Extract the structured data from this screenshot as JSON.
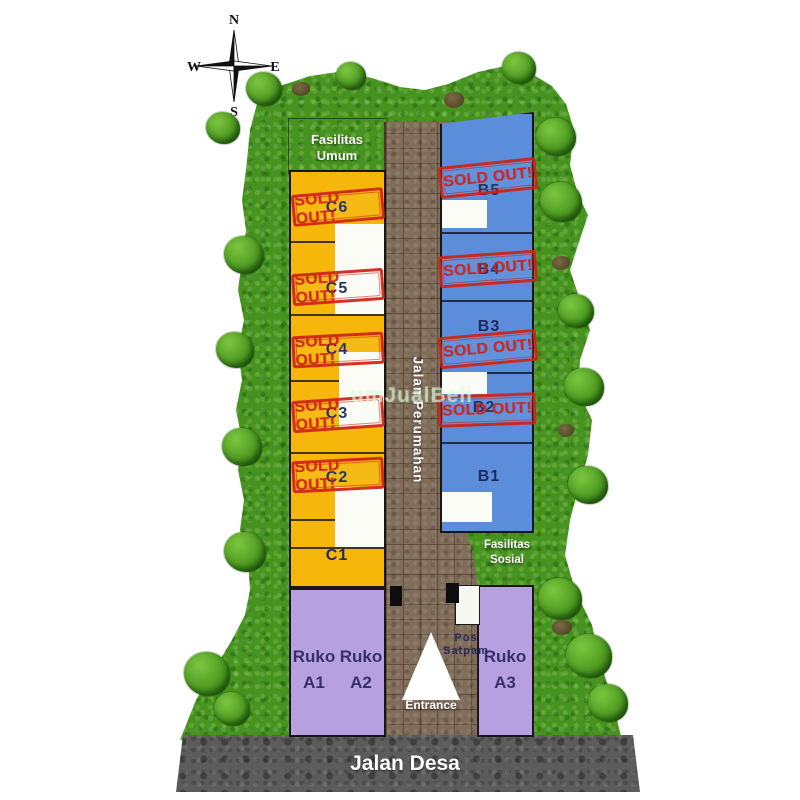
{
  "compass": {
    "north": "N",
    "east": "E",
    "south": "S",
    "west": "W"
  },
  "labels": {
    "fasilitas_umum_line1": "Fasilitas",
    "fasilitas_umum_line2": "Umum",
    "fasilitas_sosial_line1": "Fasilitas",
    "fasilitas_sosial_line2": "Sosial",
    "pos_satpam_line1": "Pos",
    "pos_satpam_line2": "Satpam",
    "entrance": "Entrance",
    "jalan_perumahan": "Jalan Perumahan",
    "jalan_desa": "Jalan Desa"
  },
  "stamp": {
    "text": "SOLD OUT!",
    "color": "#cf2318"
  },
  "blocks": {
    "c_column": {
      "color": "#f6b70a",
      "units": [
        {
          "label": "C6",
          "sold_out": true
        },
        {
          "label": "C5",
          "sold_out": true
        },
        {
          "label": "C4",
          "sold_out": true
        },
        {
          "label": "C3",
          "sold_out": true
        },
        {
          "label": "C2",
          "sold_out": true
        },
        {
          "label": "C1",
          "sold_out": false
        }
      ]
    },
    "b_column": {
      "color": "#5b8ddb",
      "units": [
        {
          "label": "B5",
          "sold_out": true
        },
        {
          "label": "B4",
          "sold_out": true
        },
        {
          "label": "B3",
          "sold_out": true
        },
        {
          "label": "B2",
          "sold_out": true
        },
        {
          "label": "B1",
          "sold_out": false
        }
      ]
    },
    "ruko": {
      "color": "#b6a0e0",
      "units": [
        {
          "line1": "Ruko",
          "line2": "A1"
        },
        {
          "line1": "Ruko",
          "line2": "A2"
        },
        {
          "line1": "Ruko",
          "line2": "A3"
        }
      ]
    }
  },
  "watermark": "umJualBeli",
  "colors": {
    "grass": "#47931f",
    "paver_road": "#7f6c59",
    "asphalt": "#5c5c5c",
    "label_navy": "#1d2a5e",
    "stamp_red": "#cf2318"
  }
}
